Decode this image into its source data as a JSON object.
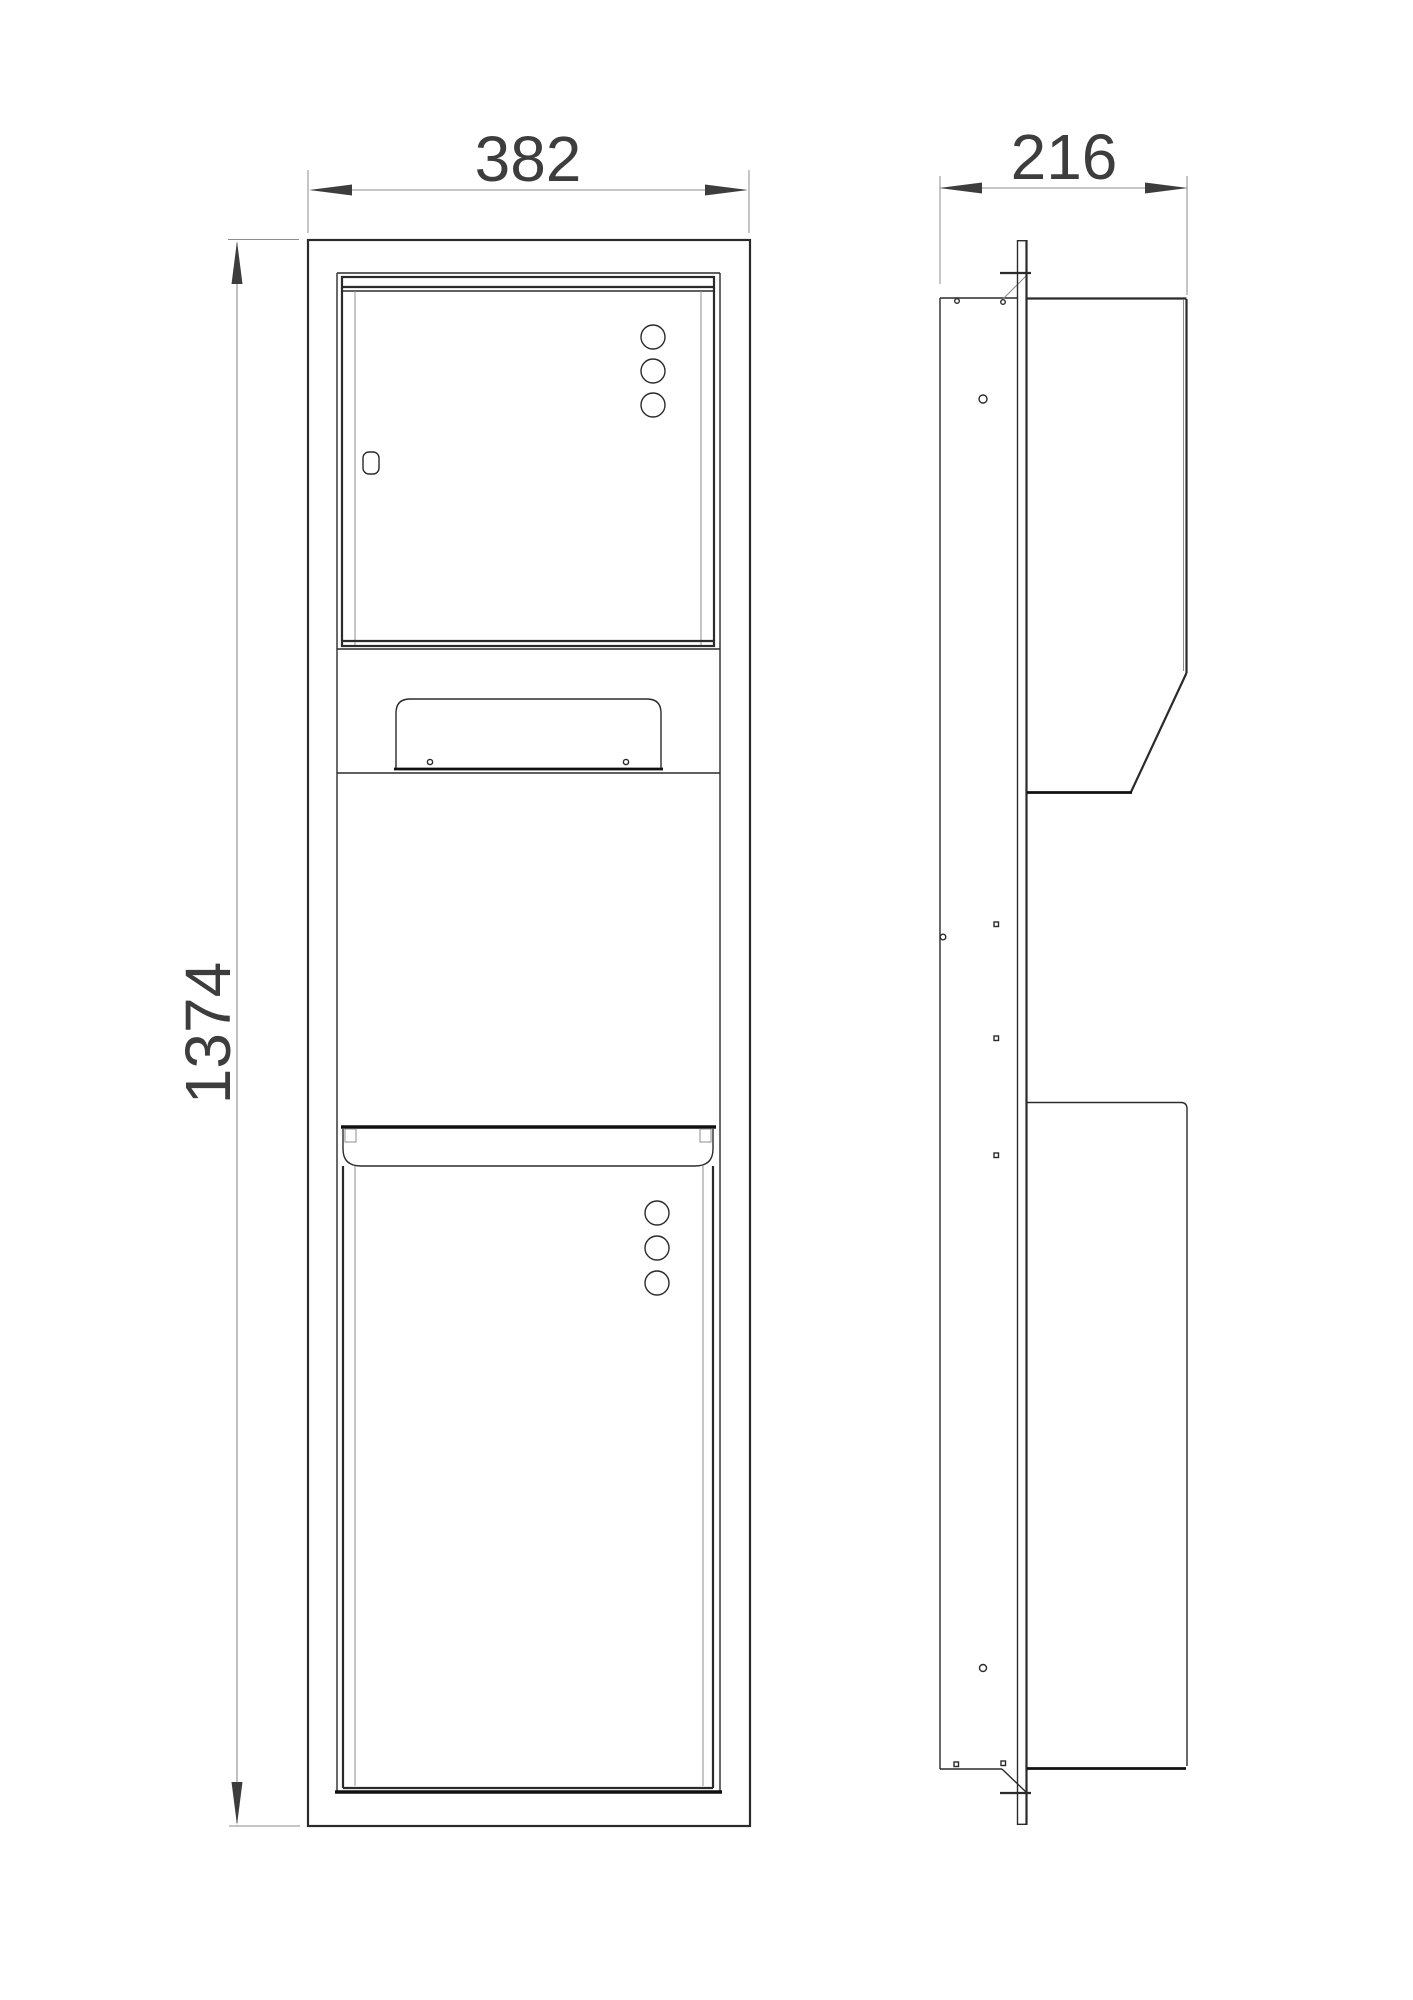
{
  "dims": {
    "width": {
      "value": "382"
    },
    "depth": {
      "value": "216"
    },
    "height": {
      "value": "1374"
    }
  },
  "colors": {
    "background": "#ffffff",
    "line": "#2b2b2b",
    "line_dark": "#101010",
    "line_thin": "#8c8c8c",
    "text": "#3d3d3d"
  }
}
